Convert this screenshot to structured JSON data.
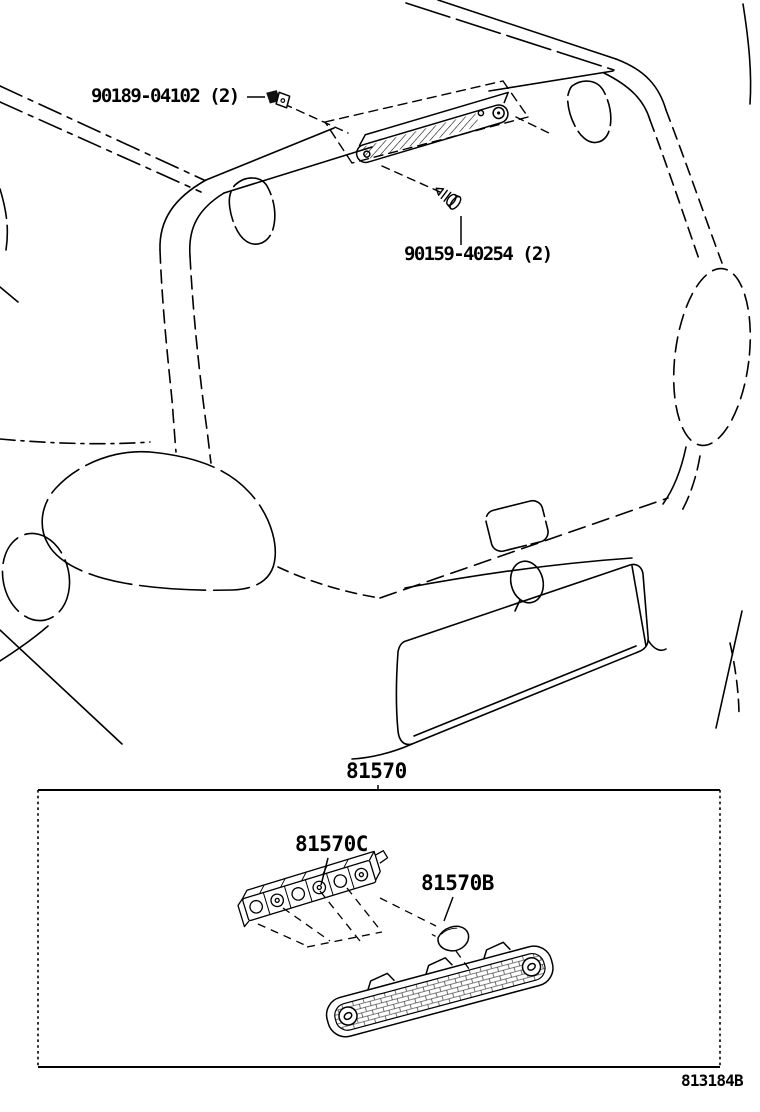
{
  "diagram": {
    "figure_code": "813184B",
    "callouts": {
      "clip": "90189-04102 (2)",
      "screw": "90159-40254 (2)"
    },
    "detail_box": {
      "assembly": "81570",
      "socket": "81570C",
      "bulb": "81570B"
    },
    "colors": {
      "ink": "#000000",
      "paper": "#ffffff"
    }
  }
}
